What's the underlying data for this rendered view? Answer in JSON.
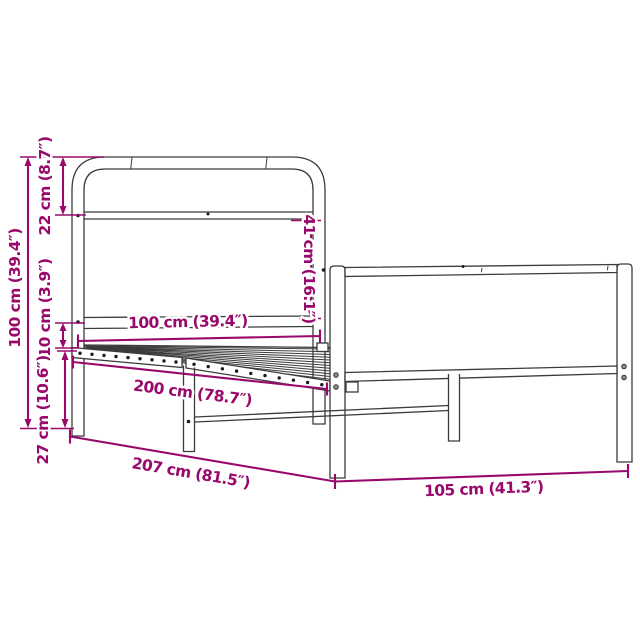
{
  "page": {
    "background_color": "#ffffff",
    "accent_color": "#99096B",
    "line_color": "#3b3b3b"
  },
  "diagram": {
    "kind": "product-dimension-diagram",
    "subject": "metal bed frame with headboard and footboard",
    "dimensions": {
      "overall_height": "100 cm (39.4″)",
      "headboard_top_section": "22 cm (8.7″)",
      "headboard_panel_height": "41 cm (16.1″)",
      "rail_gap_height": "10 cm (3.9″)",
      "under_bed_clearance": "27 cm (10.6″)",
      "bed_width": "100 cm (39.4″)",
      "slat_area_length": "200 cm (78.7″)",
      "overall_length": "207 cm (81.5″)",
      "overall_width": "105 cm (41.3″)"
    }
  }
}
